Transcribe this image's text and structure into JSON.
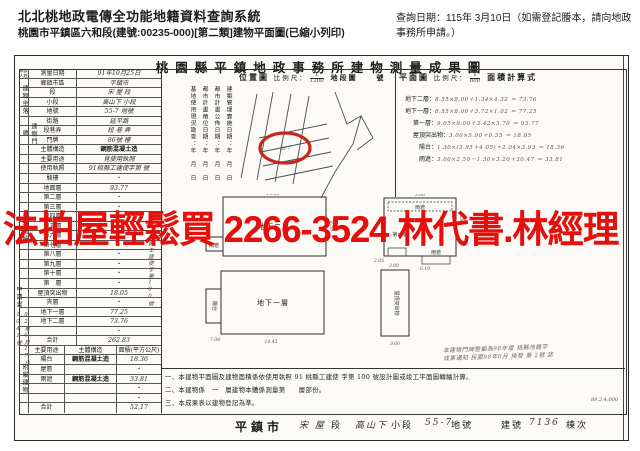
{
  "header": {
    "system_title": "北北桃地政電傳全功能地籍資料查詢系統",
    "subtitle": "桃園市平鎮區六和段(建號:00235-000)[第二類]建物平面圖(已縮小列印)",
    "query_date": "查詢日期：115年 3月10日（如需登記謄本，請向地政事務所申請。）"
  },
  "watermark": {
    "text": "法拍屋輕鬆買  2266-3524  林代書.林經理",
    "color": "#e3100e"
  },
  "document": {
    "title": "桃園縣平鎮地政事務所建物測量成果圖",
    "left_table": {
      "rows": [
        {
          "type": "t3h",
          "cells": [
            {
              "t": "申請人姓名"
            },
            {
              "t": "測量日期"
            },
            {
              "t": "91年10月25日",
              "h": 1
            }
          ]
        },
        {
          "type": "t2",
          "l": "鄉鎮市區",
          "v": "平鎮市",
          "h": 1
        },
        {
          "type": "t2",
          "l": "段",
          "v": "宋 屋 段",
          "h": 1
        },
        {
          "type": "t2",
          "l": "小段",
          "v": "高山下 小段",
          "h": 1
        },
        {
          "type": "t2",
          "l": "地號",
          "v": "55-7 地號",
          "h": 1
        },
        {
          "type": "t2",
          "l": "街路",
          "v": "延平路",
          "h": 1
        },
        {
          "type": "t2",
          "l": "段巷弄",
          "v": "段 巷 弄",
          "h": 1
        },
        {
          "type": "t2",
          "l": "門牌",
          "v": "86號 樓",
          "h": 1
        },
        {
          "type": "t2",
          "l": "主體構造",
          "v": "鋼筋混凝土造",
          "st": 1
        },
        {
          "type": "t2",
          "l": "主要用途",
          "v": "見使用執照",
          "h": 1
        },
        {
          "type": "t2",
          "l": "使用執照",
          "v": "91桃縣工建使字第 號",
          "h": 1
        },
        {
          "type": "t2",
          "l": "騎樓",
          "v": "・"
        },
        {
          "type": "t2",
          "l": "地面層",
          "v": "93.77",
          "h": 1
        },
        {
          "type": "t2",
          "l": "第二層",
          "v": "・"
        },
        {
          "type": "t2",
          "l": "第三層",
          "v": "・"
        },
        {
          "type": "t2",
          "l": "第四層",
          "v": "・"
        },
        {
          "type": "t2",
          "l": "第五層",
          "v": "・"
        },
        {
          "type": "t2",
          "l": "第六層",
          "v": "・"
        },
        {
          "type": "t2",
          "l": "第七層",
          "v": "・"
        },
        {
          "type": "t2",
          "l": "第八層",
          "v": "・"
        },
        {
          "type": "t2",
          "l": "第九層",
          "v": "・"
        },
        {
          "type": "t2",
          "l": "第十層",
          "v": "・"
        },
        {
          "type": "t2",
          "l": "第　層",
          "v": "・"
        },
        {
          "type": "t2",
          "l": "屋頂突出物",
          "v": "18.05",
          "h": 1
        },
        {
          "type": "t2",
          "l": "夾層",
          "v": "・"
        },
        {
          "type": "t2",
          "l": "地下一層",
          "v": "77.25",
          "h": 1
        },
        {
          "type": "t2",
          "l": "地下二層",
          "v": "73.76",
          "h": 1
        },
        {
          "type": "t2",
          "l": "",
          "v": "・"
        },
        {
          "type": "t2",
          "l": "合計",
          "v": "262.83",
          "h": 1
        },
        {
          "type": "t3",
          "cells": [
            {
              "t": "主要用途"
            },
            {
              "t": "主體構造"
            },
            {
              "t": "面積(平方公尺)"
            }
          ]
        },
        {
          "type": "t3",
          "cells": [
            {
              "t": "陽台"
            },
            {
              "t": "鋼筋混凝土造",
              "st": 1
            },
            {
              "t": "18.36",
              "h": 1
            }
          ]
        },
        {
          "type": "t3",
          "cells": [
            {
              "t": "屋簷"
            },
            {
              "t": ""
            },
            {
              "t": "・"
            }
          ]
        },
        {
          "type": "t3",
          "cells": [
            {
              "t": "雨遮"
            },
            {
              "t": "鋼筋混凝土造",
              "st": 1
            },
            {
              "t": "33.81",
              "h": 1
            }
          ]
        },
        {
          "type": "t3",
          "cells": [
            {
              "t": ""
            },
            {
              "t": ""
            },
            {
              "t": "・"
            }
          ]
        },
        {
          "type": "t3",
          "cells": [
            {
              "t": ""
            },
            {
              "t": ""
            },
            {
              "t": "・"
            }
          ]
        },
        {
          "type": "t3",
          "cells": [
            {
              "t": "合計"
            },
            {
              "t": ""
            },
            {
              "t": "52.17",
              "h": 1
            }
          ]
        }
      ],
      "side_labels": [
        {
          "t": "建物坐落",
          "x": 5,
          "y": 25,
          "h": 38
        },
        {
          "t": "建物門牌",
          "x": 5,
          "y": 64,
          "h": 28
        },
        {
          "t": "建物面積",
          "x": 5,
          "y": 122,
          "h": 100
        },
        {
          "t": "附屬建物",
          "x": 5,
          "y": 292,
          "h": 62
        }
      ],
      "side_hands": [
        {
          "t": "申請書",
          "x": -1,
          "y": 228,
          "h": 26,
          "print": 1
        },
        {
          "t": "92年6月17日 1041號",
          "x": -1,
          "y": 256,
          "h": 86
        },
        {
          "t": "桃縣工建使字第100號",
          "x": 131,
          "y": 178,
          "h": 100
        }
      ]
    },
    "base_panel": {
      "lines": [
        "建築管理實施日期：年 月 日",
        "都市計畫公佈日期：年 月 日",
        "都市計畫樁位日期：年 月 日",
        "基地使用現況勘查：年 月 日"
      ]
    },
    "location_map": {
      "label": "位置圖",
      "scale_label": "比例尺：",
      "scale_num": "1",
      "scale_den": "1200",
      "suffix": "地段圖",
      "unit": "號",
      "highlight_color": "#c5281f",
      "parcel_note": "55-7"
    },
    "floor_plan": {
      "label": "平面圖",
      "scale_label": "比例尺：",
      "scale_num": "1",
      "scale_den": "600",
      "calc_label": "面積計算式",
      "calcs": [
        {
          "name": "地下二層：",
          "formula": "8.55×8.00＋1.34×4.32 ＝ 73.76"
        },
        {
          "name": "地下一層：",
          "formula": "8.55×8.60＋3.72×1.02 ＝ 77.25"
        },
        {
          "name": "第一層：",
          "formula": "9.05×9.00＋3.42×3.70 ＝ 93.77"
        },
        {
          "name": "屋頂突出物：",
          "formula": "3.00×5.90＋0.35 ＝ 18.05"
        },
        {
          "name": "陽台：",
          "formula": "1.30×(3.95＋4.05)＋2.04×3.93 ＝ 18.36"
        },
        {
          "name": "雨遮：",
          "formula": "3.00×2.50－1.30×3.20＋30.47 ＝ 33.81"
        }
      ],
      "labels": [
        {
          "x": 111,
          "y": 35,
          "t": "地下二層",
          "cls": "pl"
        },
        {
          "x": 110,
          "y": 111,
          "t": "地下一層",
          "cls": "pl"
        },
        {
          "x": 237,
          "y": 42,
          "t": "第一層",
          "cls": "ps"
        },
        {
          "x": 257,
          "y": 15,
          "t": "雨遮",
          "cls": "ps"
        },
        {
          "x": 273,
          "y": 60,
          "t": "雨遮",
          "cls": "ps"
        },
        {
          "x": 51,
          "y": 53,
          "t": "雨遮",
          "cls": "ps"
        },
        {
          "x": 50,
          "y": 112,
          "t": "陽台",
          "cls": "ps",
          "v": 1
        },
        {
          "x": 232,
          "y": 109,
          "t": "屋頂突出物",
          "cls": "ps",
          "v": 1
        }
      ],
      "dims": [
        {
          "x": 110,
          "y": 1,
          "t": "14.50"
        },
        {
          "x": 167,
          "y": 32,
          "t": "8.55",
          "v": 1
        },
        {
          "x": 108,
          "y": 149,
          "t": "14.45"
        },
        {
          "x": 52,
          "y": 147,
          "t": "7.08"
        },
        {
          "x": 257,
          "y": 2,
          "t": "3.60"
        },
        {
          "x": 297,
          "y": 24,
          "t": "1.30",
          "v": 1
        },
        {
          "x": 216,
          "y": 68,
          "t": "2.05"
        },
        {
          "x": 262,
          "y": 76,
          "t": "6.10"
        },
        {
          "x": 231,
          "y": 73,
          "t": "3.00"
        },
        {
          "x": 232,
          "y": 151,
          "t": "3.00"
        }
      ]
    },
    "notes": [
      "一、本建物平面圖及建物面積係依使用執照 91 桃縣工建使 字第 100 號設計圖或竣工平面圖轉繪計算。",
      "二、本建物係　一　層建物本體係測量第　　層部份。",
      "三、本成果表以建物登記為準。"
    ],
    "stamp_note_1": "本建物門牌整編為98年度 桃縣地籍字",
    "stamp_note_2": "成果通知 民國98年6月 換發 第 2號 誌",
    "bottom_strip": [
      {
        "t": "平鎮市",
        "x": 220,
        "cls": "strip-big"
      },
      {
        "t": "宋 屋",
        "x": 284,
        "cls": "strip-hand"
      },
      {
        "t": "段",
        "x": 316,
        "cls": ""
      },
      {
        "t": "高山下",
        "x": 340,
        "cls": "strip-hand"
      },
      {
        "t": "小段",
        "x": 376,
        "cls": ""
      },
      {
        "t": "55-7",
        "x": 410,
        "cls": "strip-hand"
      },
      {
        "t": "地號",
        "x": 436,
        "cls": ""
      },
      {
        "t": "建號",
        "x": 486,
        "cls": ""
      },
      {
        "t": "7136",
        "x": 514,
        "cls": "strip-hand"
      },
      {
        "t": "棟次",
        "x": 551,
        "cls": ""
      }
    ],
    "form_no": "89.2.4,000"
  }
}
